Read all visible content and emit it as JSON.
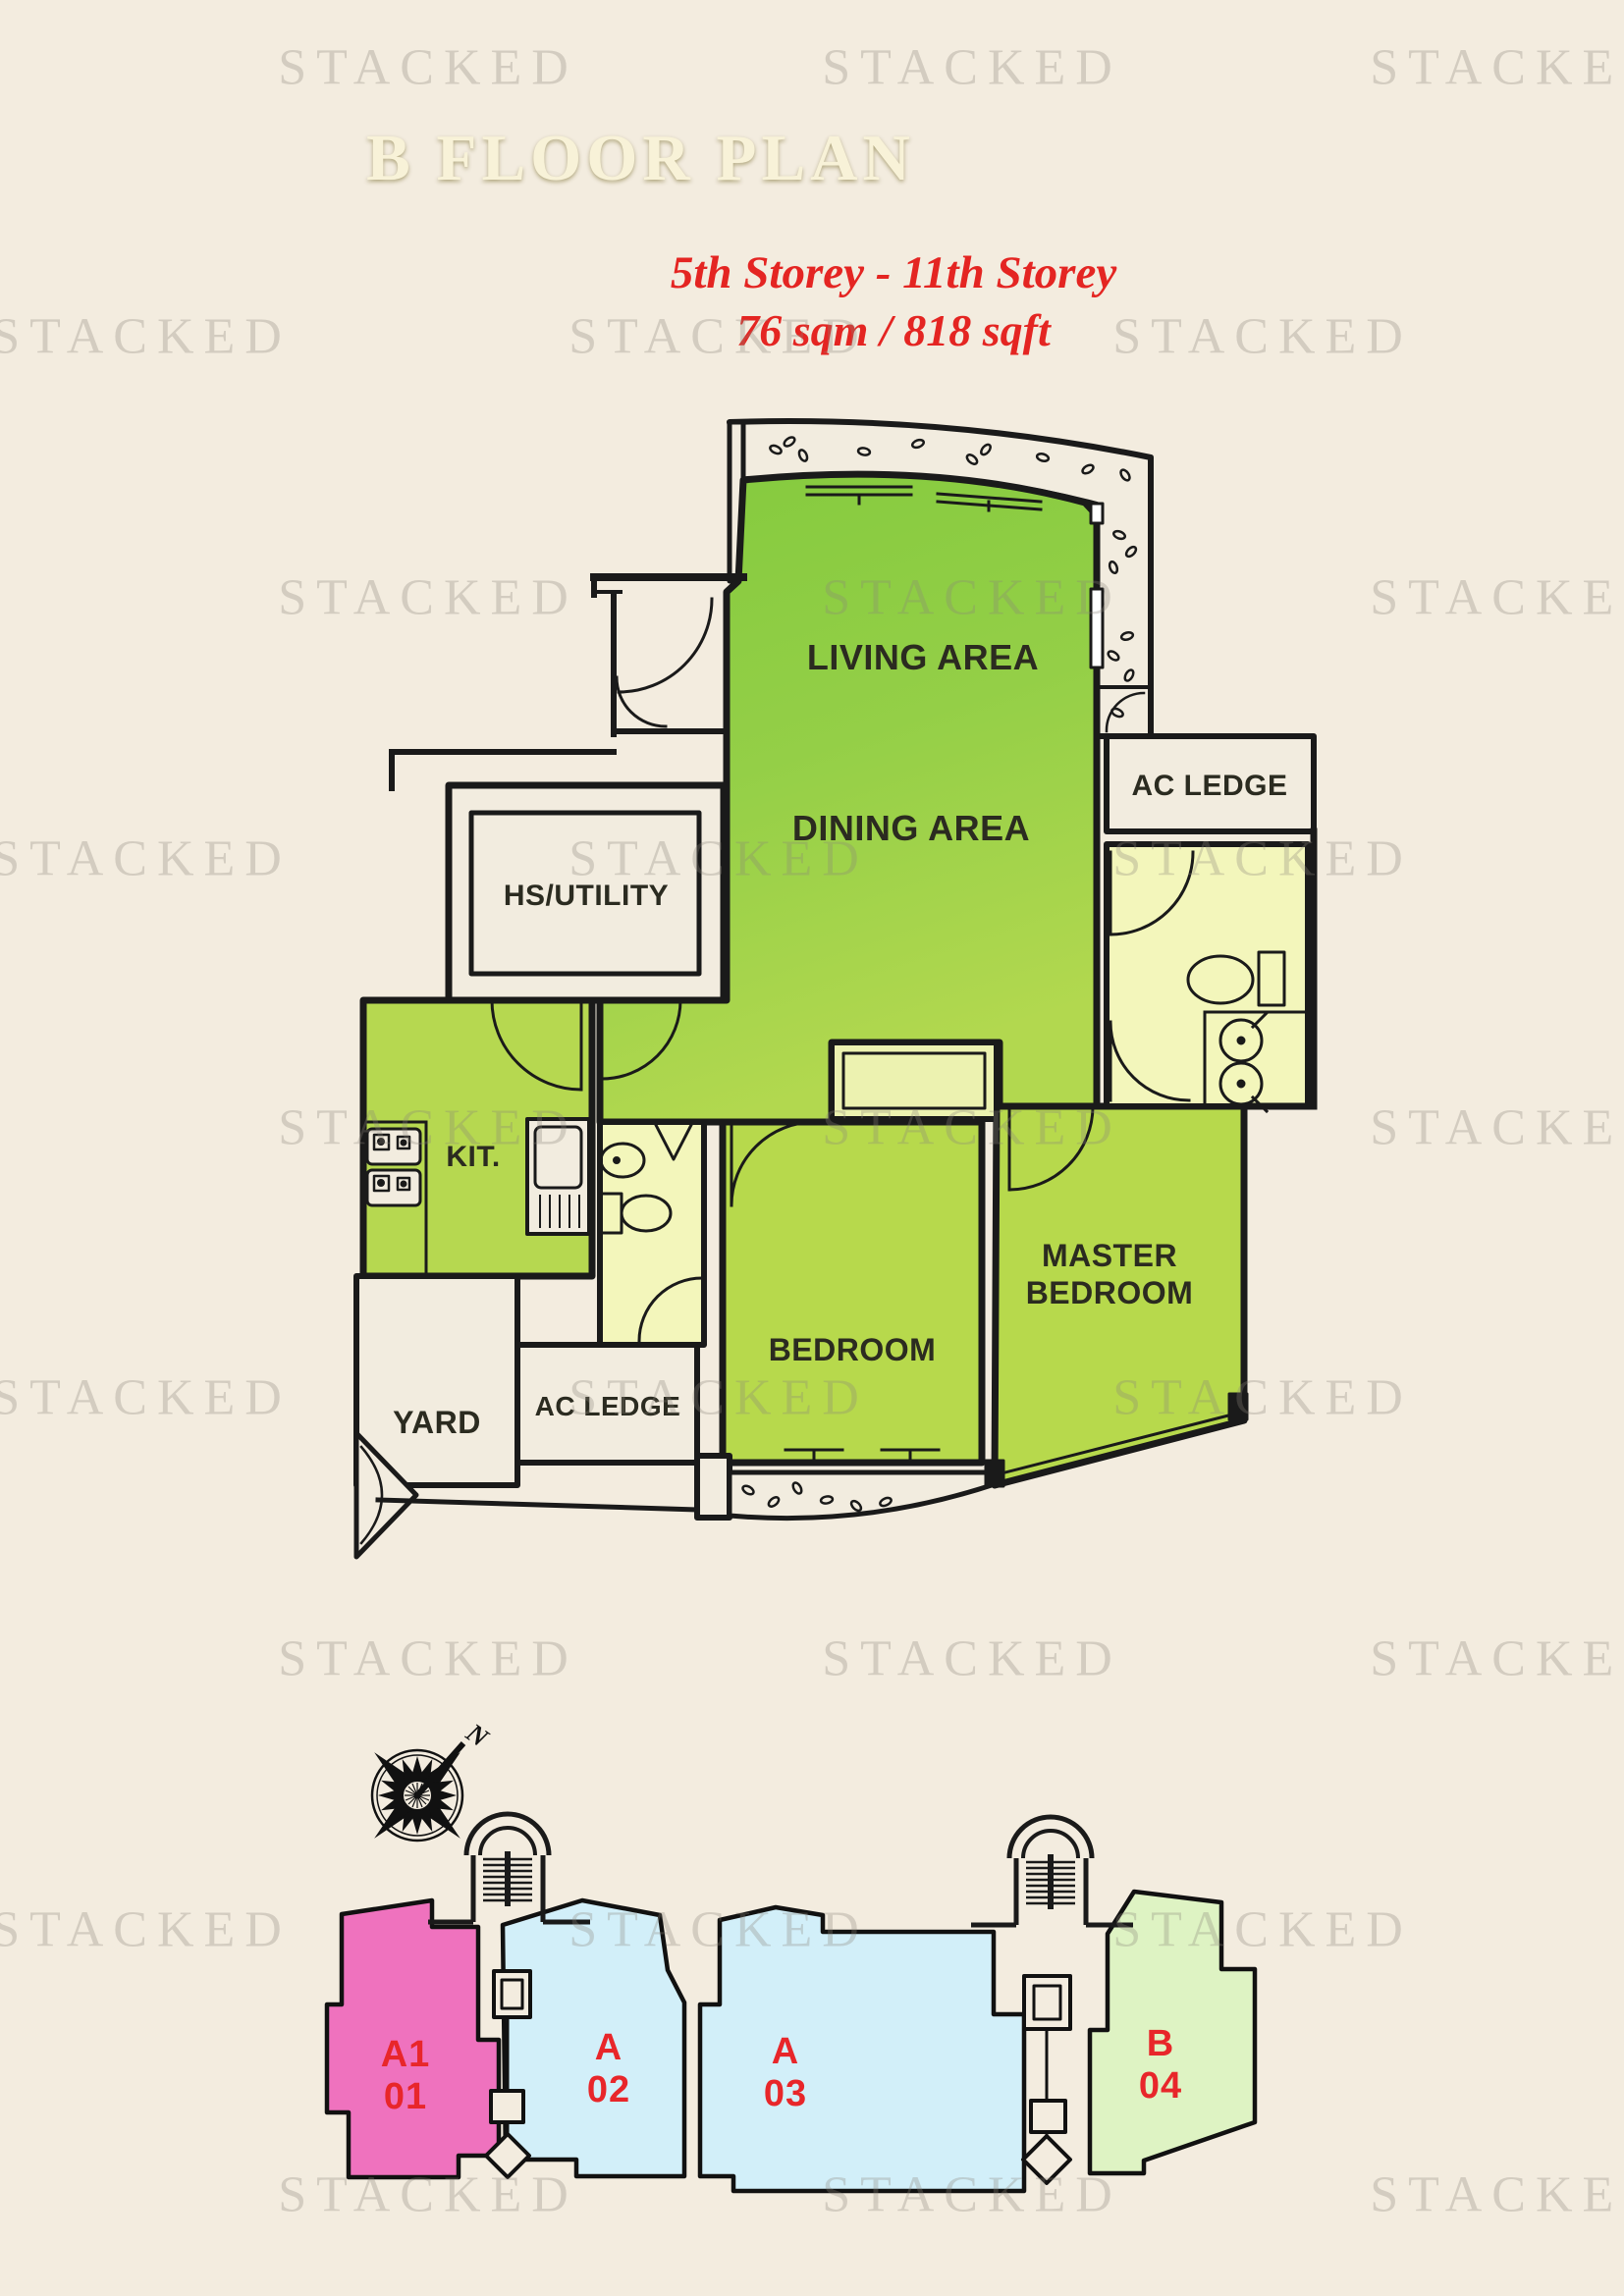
{
  "watermark": "STACKED",
  "header": {
    "title": "B FLOOR PLAN",
    "storey_range": "5th Storey - 11th Storey",
    "area": "76 sqm / 818 sqft"
  },
  "floor_plan": {
    "living_area": "LIVING AREA",
    "dining_area": "DINING AREA",
    "ac_ledge_top": "AC LEDGE",
    "hs_utility": "HS/UTILITY",
    "kitchen": "KIT.",
    "yard": "YARD",
    "ac_ledge_bottom": "AC LEDGE",
    "bedroom": "BEDROOM",
    "master_bedroom_line1": "MASTER",
    "master_bedroom_line2": "BEDROOM"
  },
  "site_plan": {
    "compass_label": "N",
    "units": [
      {
        "block": "A1",
        "number": "01",
        "color": "#ef72be"
      },
      {
        "block": "A",
        "number": "02",
        "color": "#d2eff9"
      },
      {
        "block": "A",
        "number": "03",
        "color": "#d2eff9"
      },
      {
        "block": "B",
        "number": "04",
        "color": "#def3c3"
      }
    ]
  },
  "colors": {
    "background": "#f3ecdf",
    "banner_gold_dark": "#8e7d13",
    "banner_gold_light": "#f6f2ae",
    "accent_red": "#e42522",
    "plan_green": "#8ccc45",
    "plan_green_light": "#b7d94c",
    "bath_yellow": "#f3f6bb",
    "wall": "#1a1a1a",
    "unit_pink": "#ef72be",
    "unit_blue": "#d2eff9",
    "unit_green": "#def3c3"
  }
}
